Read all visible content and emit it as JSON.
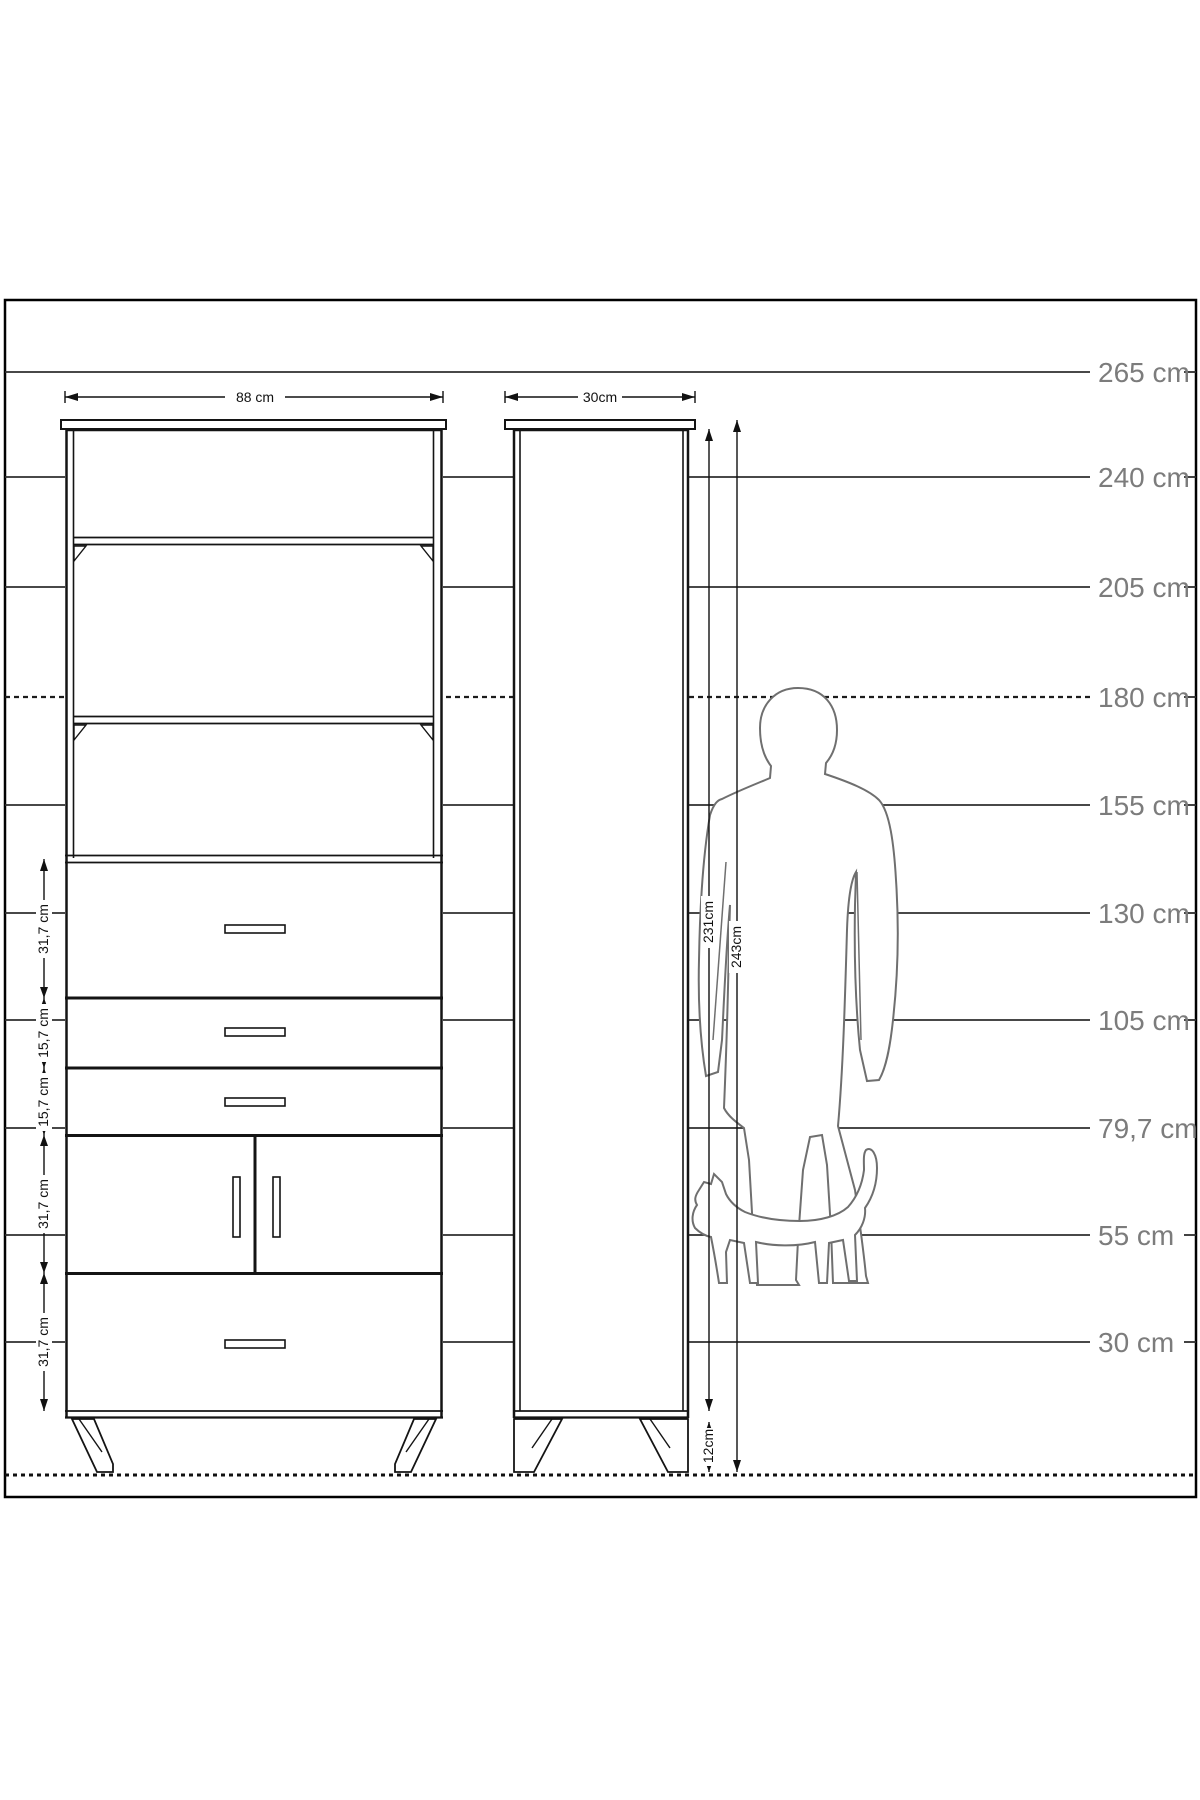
{
  "diagram": {
    "type": "furniture-dimension-diagram",
    "scale": {
      "unit": "cm",
      "labels": [
        "265 cm",
        "240 cm",
        "205 cm",
        "180 cm",
        "155 cm",
        "130 cm",
        "105 cm",
        "79,7 cm",
        "55 cm",
        "30 cm"
      ],
      "values": [
        265,
        240,
        205,
        180,
        155,
        130,
        105,
        79.7,
        55,
        30
      ],
      "dashed_level_label": "180 cm"
    },
    "front_view": {
      "width_label": "88 cm",
      "section_labels": [
        "31,7 cm",
        "15,7 cm",
        "15,7 cm",
        "31,7 cm",
        "31,7 cm"
      ],
      "open_shelf_count": 3,
      "drawer_count": 4,
      "door_count": 2
    },
    "side_view": {
      "depth_label": "30cm",
      "body_height_label": "231cm",
      "total_height_label": "243cm",
      "leg_height_label": "12cm"
    },
    "figures": [
      "standing-man-silhouette",
      "walking-cat-silhouette"
    ]
  }
}
